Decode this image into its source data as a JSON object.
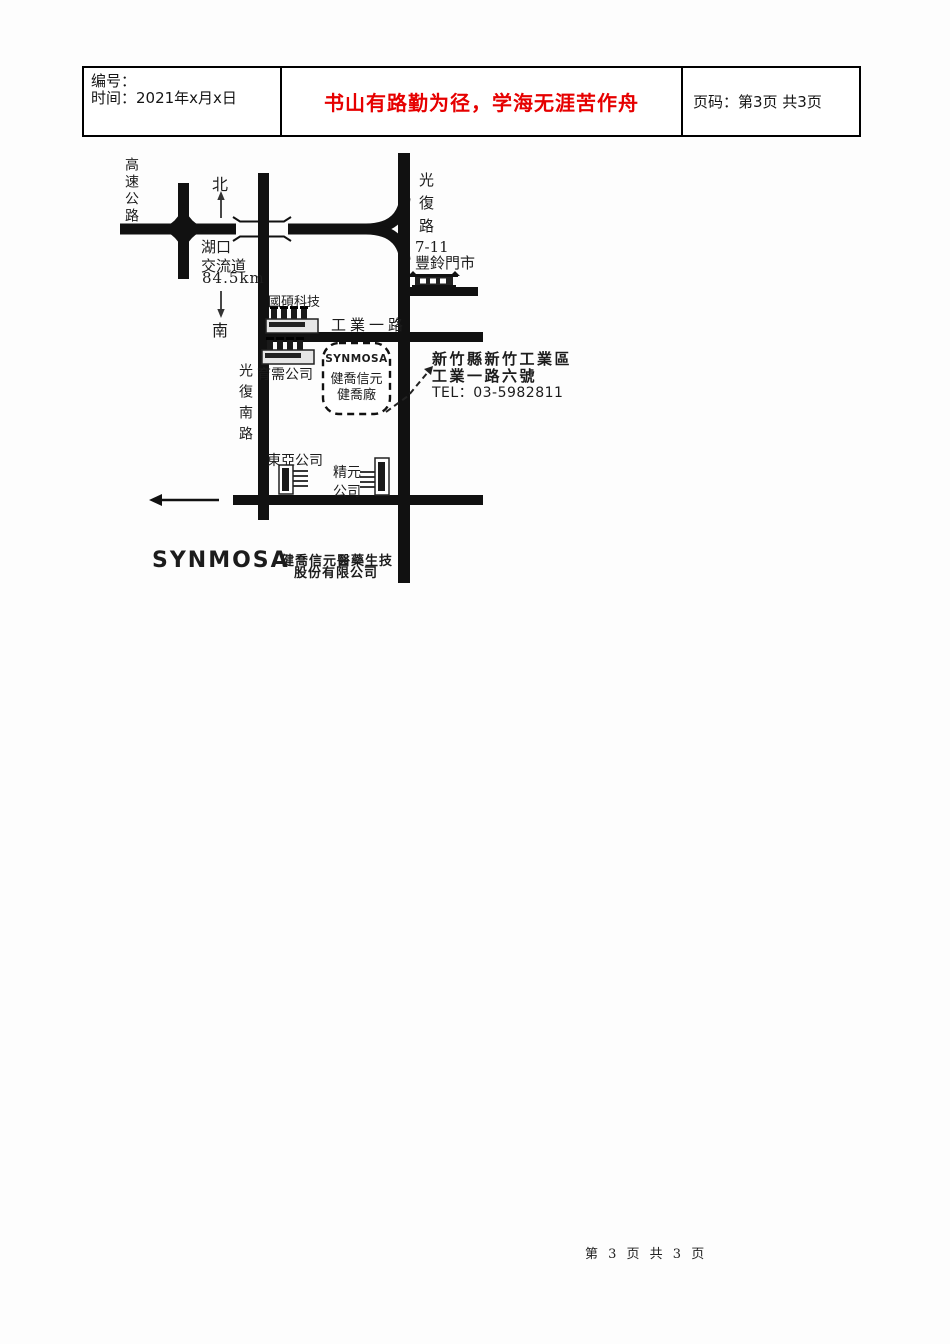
{
  "colors": {
    "slogan_red": "#e60000",
    "ink": "#111111"
  },
  "header": {
    "number_label": "编号：",
    "time_label": "时间：2021年x月x日",
    "slogan": "书山有路勤为径，学海无涯苦作舟",
    "page_label": "页码：第3页 共3页"
  },
  "map": {
    "highway": "高速公路",
    "compass_north": "北",
    "compass_south": "南",
    "interchange": {
      "line1": "湖口",
      "line2": "交流道",
      "distance": "84.5km"
    },
    "roads": {
      "guangfu": "光復路",
      "guangfu_south": "光復南路",
      "industry_first": "工業一路"
    },
    "landmarks": {
      "seven_eleven_line1": "7-11",
      "seven_eleven_line2": "豐鈴門市",
      "guoshuo": "國碩科技",
      "yuxu": "育需公司",
      "dongya": "東亞公司",
      "jingyuan_line1": "精元",
      "jingyuan_line2": "公司"
    },
    "plant_box": {
      "brand": "SYNMOSA",
      "line1": "健喬信元",
      "line2": "健喬廠"
    },
    "address": {
      "line1": "新竹縣新竹工業區",
      "line2": "工業一路六號",
      "tel": "TEL：03-5982811"
    },
    "company": {
      "logo": "SYNMOSA",
      "name_line1": "健喬信元醫藥生技",
      "name_line2": "股份有限公司"
    },
    "icons": {
      "north_arrow": "↑",
      "south_arrow": "↓",
      "west_arrow": "←",
      "factory": "factory-with-chimneys",
      "store": "storefront",
      "building": "office-building"
    }
  },
  "footer": {
    "page_text": "第 3 页 共 3 页"
  }
}
